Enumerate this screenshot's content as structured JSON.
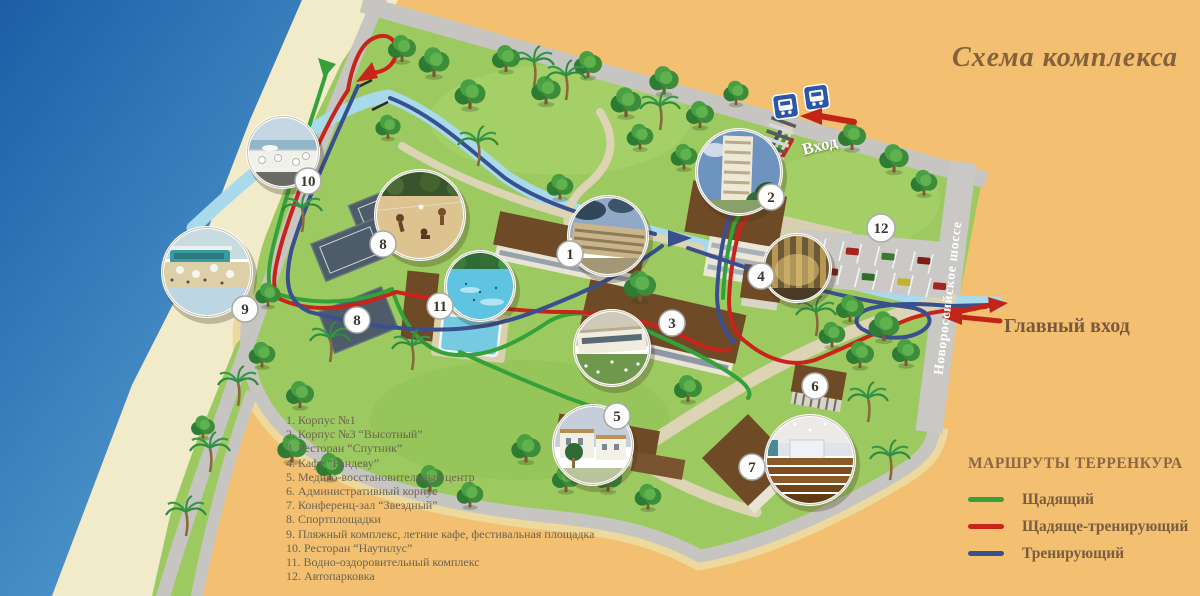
{
  "title": "Схема комплекса",
  "map": {
    "entrance_label": "Вход",
    "main_entrance_label": "Главный вход",
    "highway_label": "Новороссийское шоссе",
    "badges": [
      "1",
      "2",
      "3",
      "4",
      "5",
      "6",
      "7",
      "8",
      "8",
      "9",
      "10",
      "11",
      "12"
    ]
  },
  "legend": {
    "items": [
      "1. Корпус №1",
      "2. Корпус №3 “Высотный”",
      "3. Ресторан “Спутник”",
      "4. Кафе “Рандеву”",
      "5. Медико-восстановительный центр",
      "6. Административный корпус",
      "7. Конференц-зал “Звездный”",
      "8. Спортплощадки",
      "9. Пляжный комплекс, летние кафе, фестивальная площадка",
      "10. Ресторан “Наутилус”",
      "11. Водно-оздоровительный комплекс",
      "12. Автопарковка"
    ]
  },
  "routes_legend": {
    "header": "МАРШРУТЫ ТЕРРЕНКУРА",
    "routes": [
      {
        "label": "Щадящий",
        "color": "#35a13b"
      },
      {
        "label": "Щадяще-тренирующий",
        "color": "#c9241a"
      },
      {
        "label": "Тренирующий",
        "color": "#3a4f8e"
      }
    ]
  },
  "palette": {
    "background": "#f3bf70",
    "sea": "#2b6cb0",
    "sand": "#f2ebca",
    "grass": "#9dca60",
    "road": "#c7c6c2",
    "river": "#a9daec",
    "roof_brown": "#6f4a27",
    "label_brown": "#7a5c40"
  }
}
